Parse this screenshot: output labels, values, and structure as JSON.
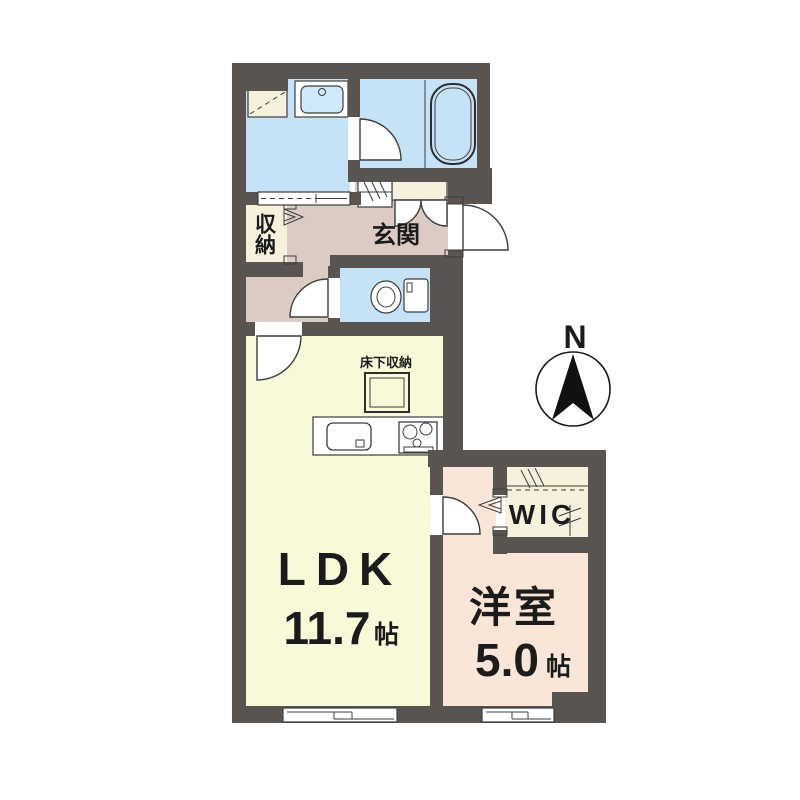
{
  "plan_title": "1LDK floor plan",
  "colors": {
    "wall": "#59544f",
    "water": "#c5e2f6",
    "water_fixture": "#cfe8fa",
    "hall": "#dccac4",
    "ldk": "#f8f9d8",
    "bedroom": "#f9e6d8",
    "closet": "#f5f1dc",
    "white": "#ffffff",
    "line": "#3d3d3d",
    "text": "#1b1b1b",
    "compass_black": "#111111"
  },
  "rooms": {
    "ldk": {
      "name": "LDK",
      "size": "11.7",
      "size_unit": "帖"
    },
    "bedroom": {
      "name": "洋室",
      "size": "5.0",
      "size_unit": "帖"
    },
    "wic": {
      "label": "WIC"
    },
    "entrance": {
      "label": "玄関"
    },
    "storage": {
      "label": "収納"
    },
    "underfloor_storage": {
      "label": "床下収納"
    }
  },
  "compass": {
    "north_label": "N"
  }
}
